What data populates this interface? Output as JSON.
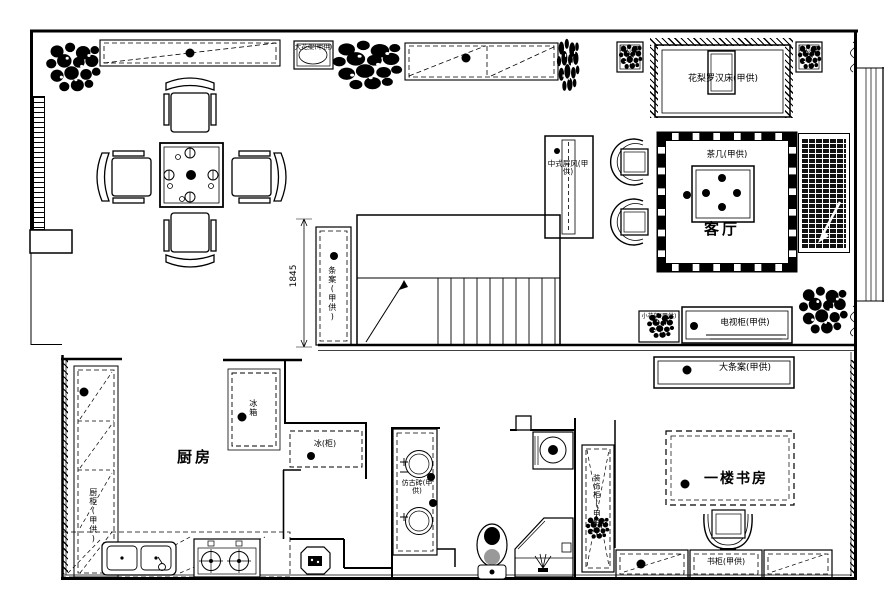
{
  "page": {
    "background": "#ffffff",
    "ink": "#000000",
    "type": "apartment floor plan (CAD line drawing)"
  },
  "rooms": {
    "living_room": "客厅",
    "kitchen": "厨房",
    "study": "一楼书房"
  },
  "furniture_labels": {
    "flower_rack_large": "大花架(甲供)",
    "side_table_left": "边几(甲供)",
    "side_table_right": "边几(甲供)",
    "luohan_bed": "花梨罗汉床(甲供)",
    "chinese_screen": "中式屏风(甲供)",
    "coffee_table": "茶几(甲供)",
    "console_table": "条案(甲供)",
    "flower_rack_small": "小花架(甲供)",
    "tv_cabinet": "电视柜(甲供)",
    "console_table_large": "大条案(甲供)",
    "kitchen_cabinet": "厨柜(甲供)",
    "fridge": "冰箱",
    "freezer": "冰(柜)",
    "antique_tile": "仿古砖(甲供)",
    "decor_cabinet": "装饰柜(甲供)",
    "bookcase": "书柜(甲供)"
  },
  "dimensions": {
    "stair_width": "1845"
  }
}
